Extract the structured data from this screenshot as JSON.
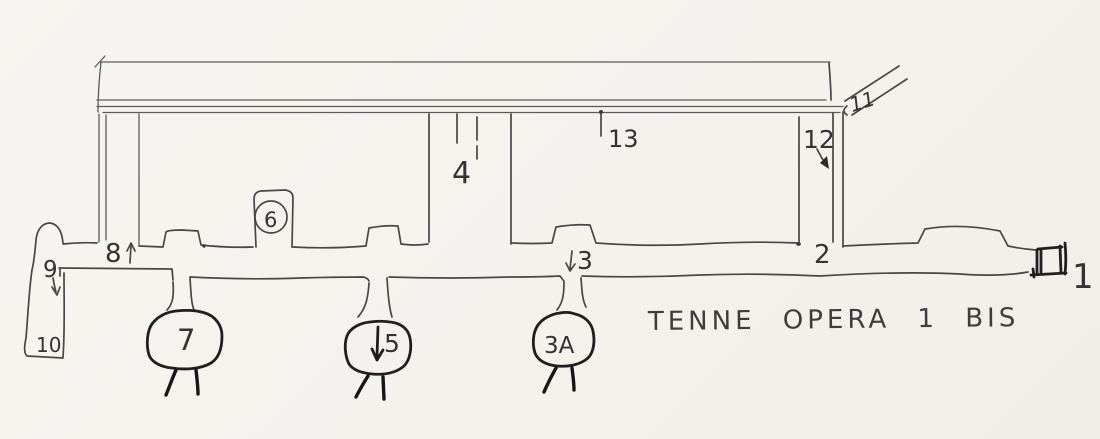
{
  "title": "TENNE OPERA 1 BIS",
  "figure": {
    "kind": "hand-drawn tunnel plan sketch",
    "colors": {
      "paper": "#f6f4f0",
      "ink": "#474747",
      "heavy_ink": "#1f1f1f"
    },
    "labels": {
      "p1": {
        "text": "1",
        "meaning": "entrance at right end of main gallery"
      },
      "p2": {
        "text": "2",
        "meaning": "base of right connecting corridor"
      },
      "p3": {
        "text": "3",
        "meaning": "branch down to chamber 3A"
      },
      "p3a": {
        "text": "3A",
        "meaning": "lower chamber 3A"
      },
      "p4": {
        "text": "4",
        "meaning": "stubs on upper gallery"
      },
      "p5": {
        "text": "5",
        "meaning": "lower chamber 5"
      },
      "p6": {
        "text": "6",
        "meaning": "niche 6 (circled)"
      },
      "p7": {
        "text": "7",
        "meaning": "lower chamber 7"
      },
      "p8": {
        "text": "8",
        "meaning": "left corridor junction, arrow up"
      },
      "p9": {
        "text": "9",
        "meaning": "descent at left end, arrow down"
      },
      "p10": {
        "text": "10",
        "meaning": "lower left chamber"
      },
      "p11": {
        "text": "11",
        "meaning": "diagonal passage at top right"
      },
      "p12": {
        "text": "12",
        "meaning": "right corridor, arrow down"
      },
      "p13": {
        "text": "13",
        "meaning": "point on upper gallery"
      }
    }
  }
}
